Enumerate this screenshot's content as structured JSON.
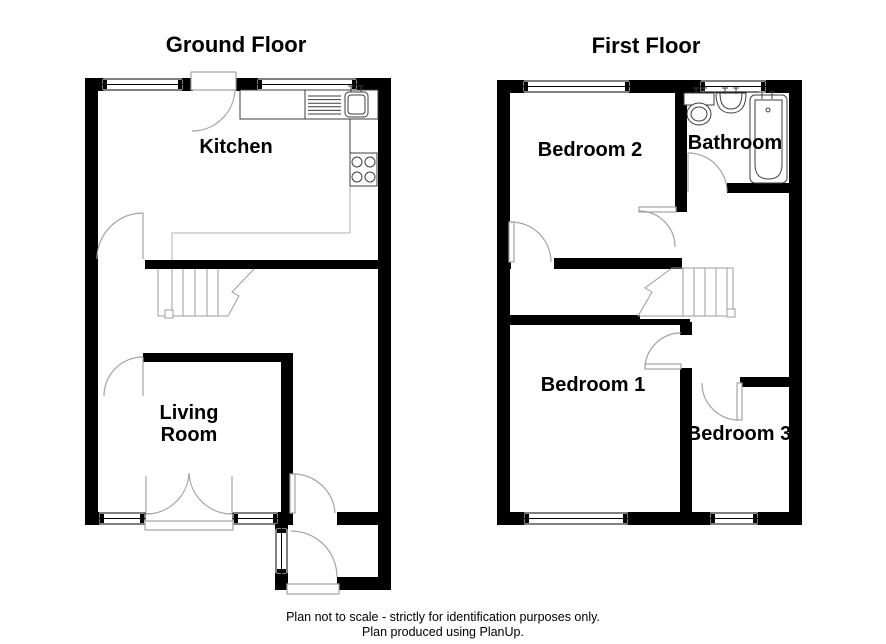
{
  "titles": {
    "ground_floor": "Ground Floor",
    "first_floor": "First Floor"
  },
  "ground_floor": {
    "rooms": {
      "kitchen": "Kitchen",
      "living_room_line1": "Living",
      "living_room_line2": "Room"
    }
  },
  "first_floor": {
    "rooms": {
      "bedroom1": "Bedroom 1",
      "bedroom2": "Bedroom 2",
      "bedroom3": "Bedroom 3",
      "bathroom": "Bathroom"
    }
  },
  "footer": {
    "line1": "Plan not to scale - strictly for identification purposes only.",
    "line2": "Plan produced using PlanUp."
  },
  "colors": {
    "wall": "#000000",
    "door_line": "#a3a3a3",
    "stair_line": "#9b9b9b",
    "fixture_line": "#3d3d3d",
    "background": "#ffffff"
  }
}
